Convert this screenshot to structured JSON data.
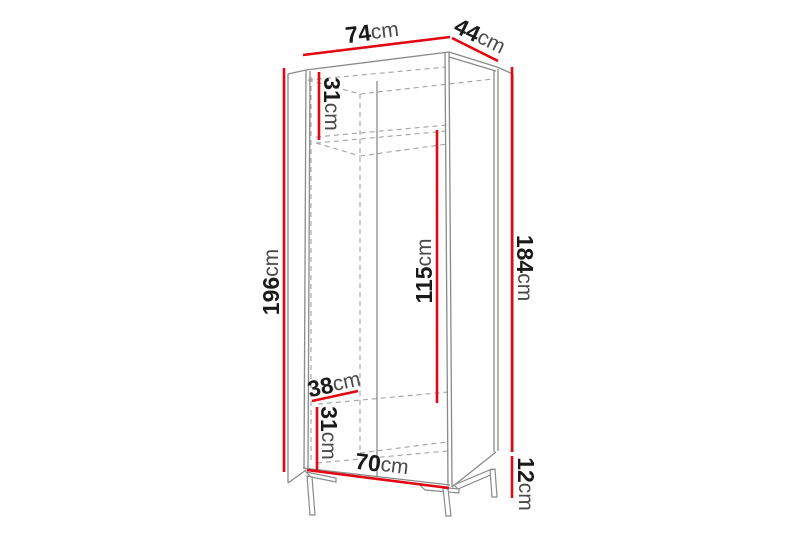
{
  "diagram": {
    "type": "furniture-dimension-diagram",
    "subject": "tall two-compartment wardrobe on metal legs, perspective line drawing",
    "unit": "cm",
    "background": "#ffffff",
    "colors": {
      "dimension_line": "#e30613",
      "outline": "#8a8a8a",
      "hidden_line": "#a2a2a2",
      "number": "#1a1a1a",
      "unit_text": "#4a4a49"
    },
    "dimensions": [
      {
        "id": "outer-width",
        "value": "74",
        "unit": "cm"
      },
      {
        "id": "outer-depth",
        "value": "44",
        "unit": "cm"
      },
      {
        "id": "total-height",
        "value": "196",
        "unit": "cm"
      },
      {
        "id": "top-compartment-height",
        "value": "31",
        "unit": "cm"
      },
      {
        "id": "hanging-space-height",
        "value": "115",
        "unit": "cm"
      },
      {
        "id": "body-height",
        "value": "184",
        "unit": "cm"
      },
      {
        "id": "inner-depth",
        "value": "38",
        "unit": "cm"
      },
      {
        "id": "bottom-compartment-height",
        "value": "31",
        "unit": "cm"
      },
      {
        "id": "inner-width",
        "value": "70",
        "unit": "cm"
      },
      {
        "id": "leg-height",
        "value": "12",
        "unit": "cm"
      }
    ]
  }
}
